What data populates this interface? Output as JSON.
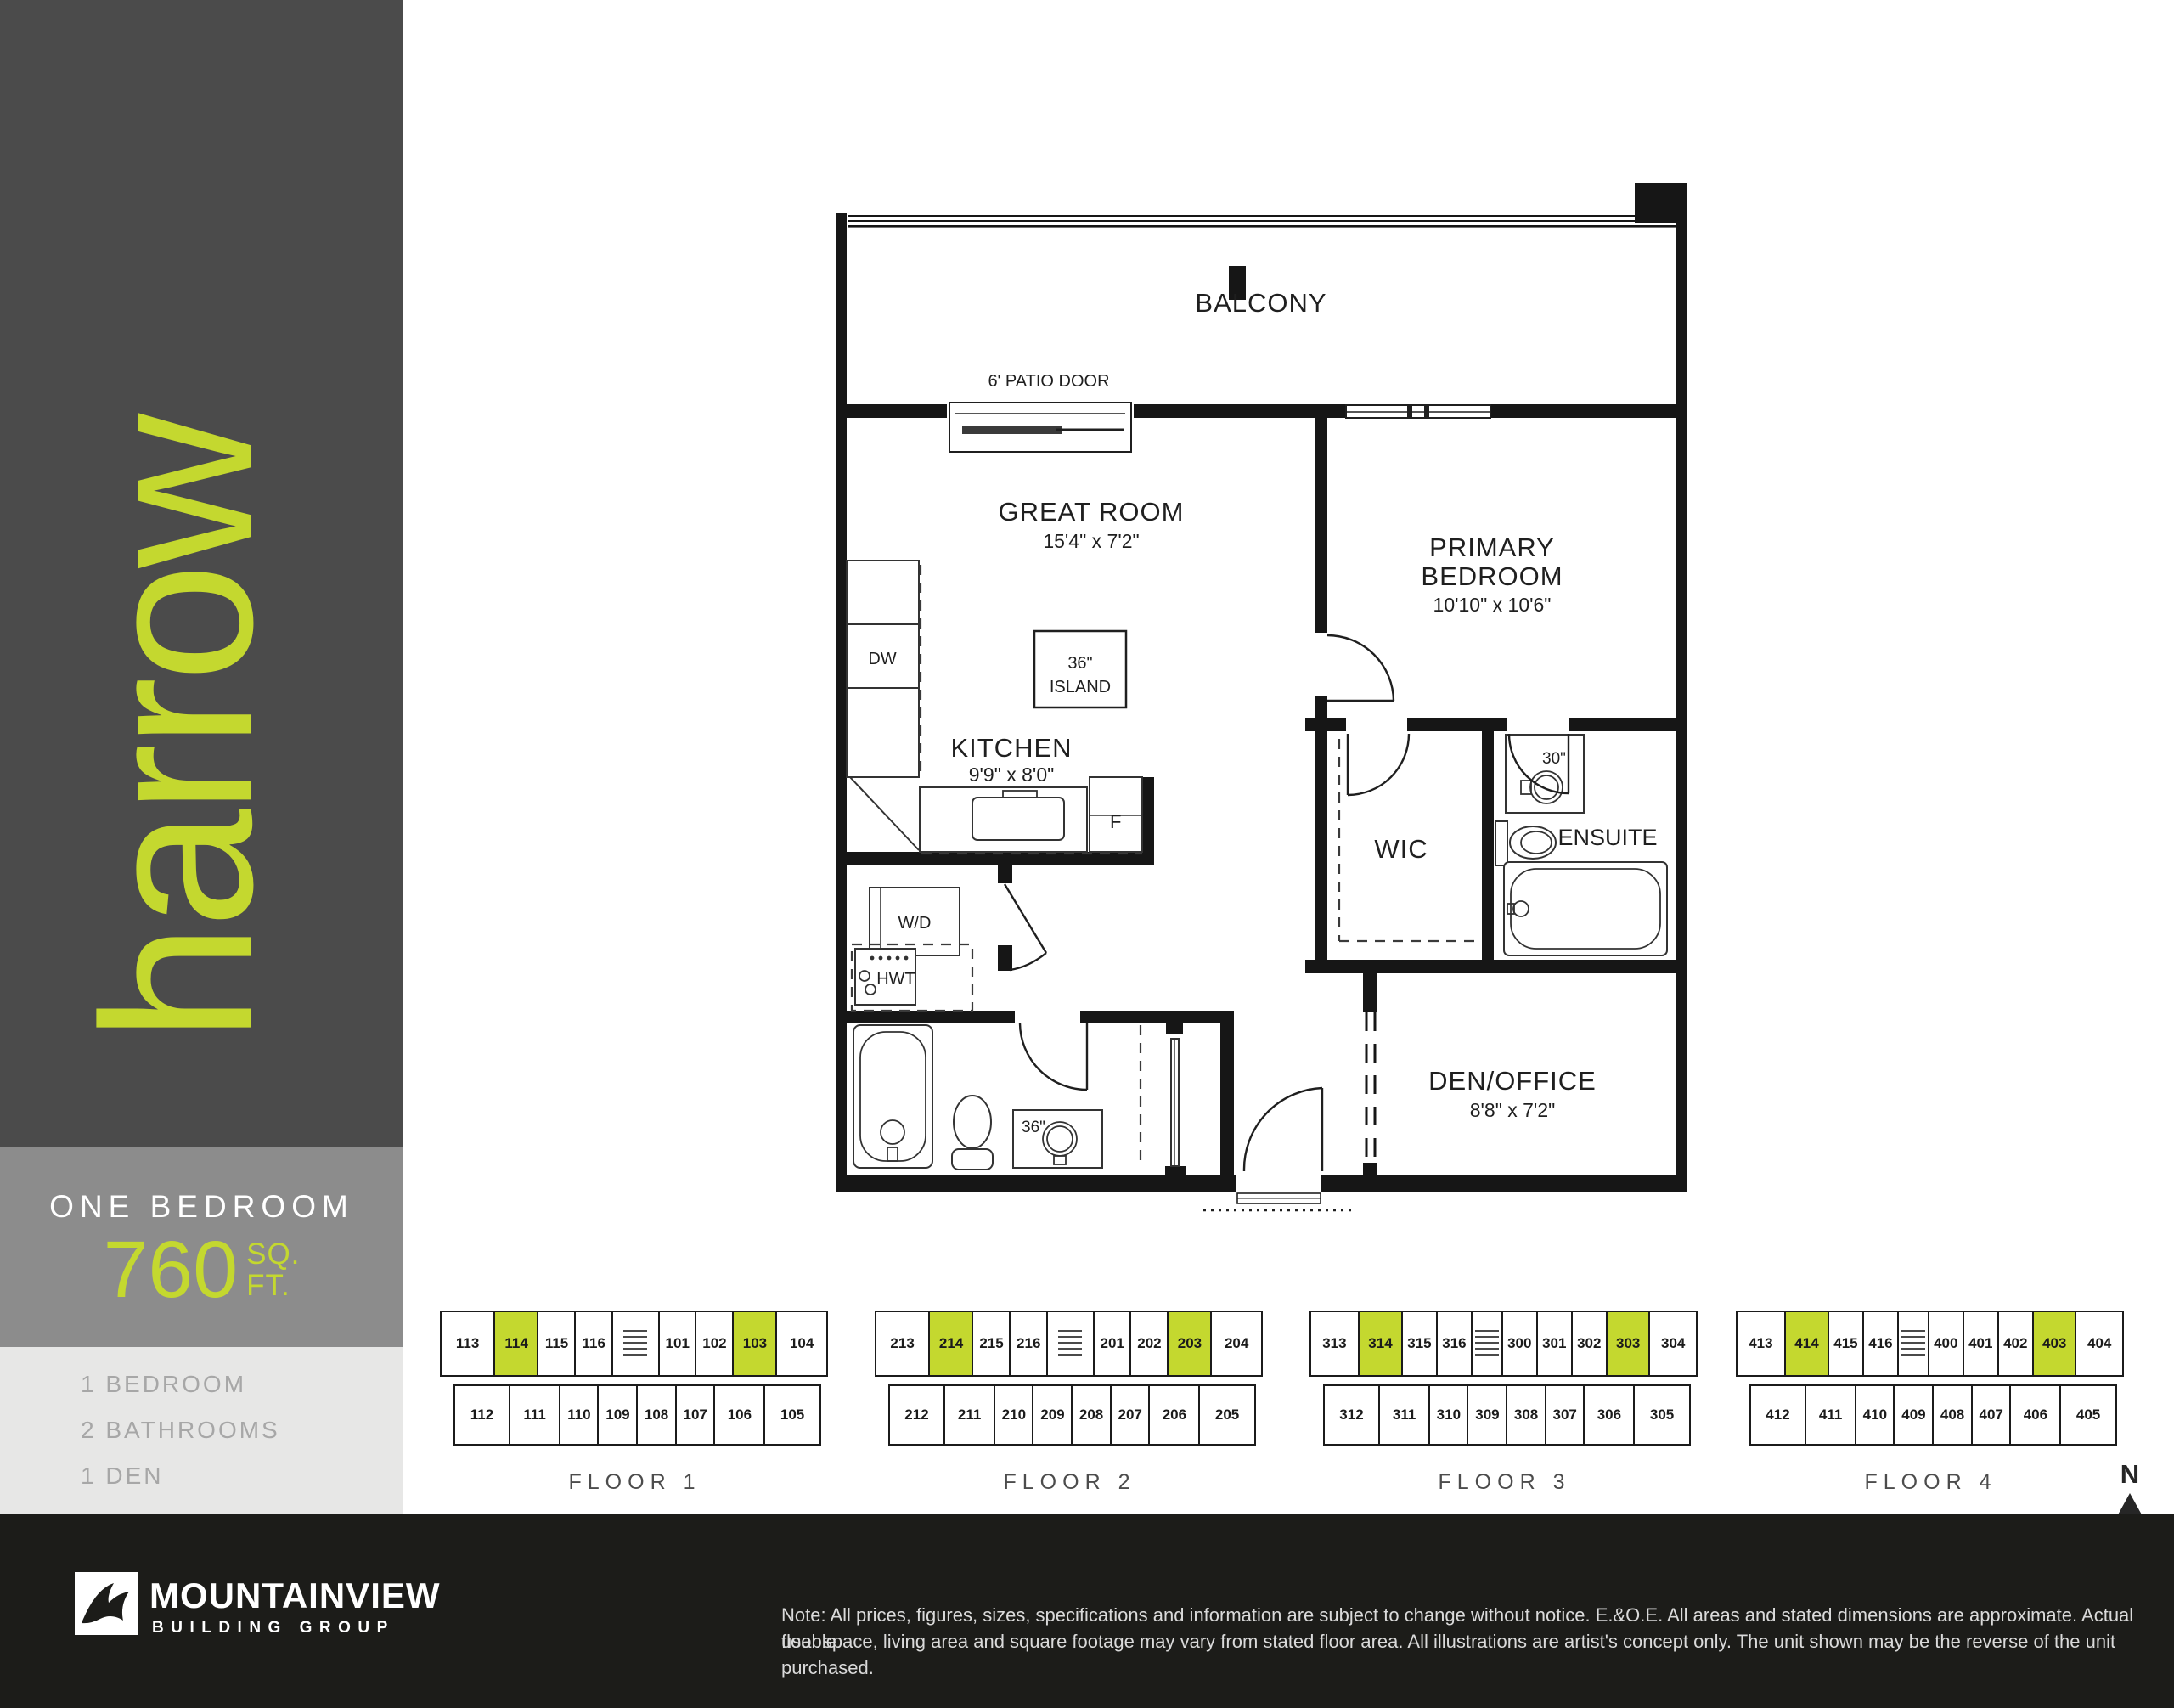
{
  "colors": {
    "brand_lime": "#c4d82f",
    "sidebar_dark": "#4b4b4b",
    "band_gray": "#8c8c8c",
    "band_light": "#e7e7e6",
    "footer_black": "#1c1c19"
  },
  "sidebar": {
    "brand": "harrow",
    "unit_type": "ONE BEDROOM",
    "area_value": "760",
    "area_unit_top": "SQ.",
    "area_unit_bottom": "FT.",
    "features": [
      "1 BEDROOM",
      "2 BATHROOMS",
      "1 DEN"
    ]
  },
  "floor_plan": {
    "labels": {
      "balcony": "BALCONY",
      "patio_door": "6' PATIO DOOR",
      "great_room": "GREAT ROOM",
      "great_room_dims": "15'4\" x 7'2\"",
      "primary_line1": "PRIMARY",
      "primary_line2": "BEDROOM",
      "primary_dims": "10'10\" x 10'6\"",
      "kitchen": "KITCHEN",
      "kitchen_dims": "9'9\" x 8'0\"",
      "island_line1": "36\"",
      "island_line2": "ISLAND",
      "dw": "DW",
      "fridge": "F",
      "wd": "W/D",
      "hwt": "HWT",
      "wic": "WIC",
      "ensuite": "ENSUITE",
      "vanity_30": "30\"",
      "vanity_36": "36\"",
      "den": "DEN/OFFICE",
      "den_dims": "8'8\" x 7'2\""
    }
  },
  "floors": [
    {
      "label": "FLOOR 1",
      "top": [
        {
          "n": "113",
          "w": 1.4
        },
        {
          "n": "114",
          "hl": true,
          "w": 1.12
        },
        {
          "n": "115",
          "w": 0.95
        },
        {
          "n": "116",
          "w": 0.95
        },
        {
          "core": true,
          "w": 1.2
        },
        {
          "n": "101",
          "w": 0.95
        },
        {
          "n": "102",
          "w": 0.95
        },
        {
          "n": "103",
          "hl": true,
          "w": 1.12
        },
        {
          "n": "104",
          "w": 1.3
        }
      ],
      "bottom": [
        {
          "n": "112",
          "w": 1.45
        },
        {
          "n": "111",
          "w": 1.3
        },
        {
          "n": "110",
          "w": 1
        },
        {
          "n": "109",
          "w": 1
        },
        {
          "n": "108",
          "w": 1
        },
        {
          "n": "107",
          "w": 1
        },
        {
          "n": "106",
          "w": 1.3
        },
        {
          "n": "105",
          "w": 1.45
        }
      ]
    },
    {
      "label": "FLOOR 2",
      "top": [
        {
          "n": "213",
          "w": 1.4
        },
        {
          "n": "214",
          "hl": true,
          "w": 1.12
        },
        {
          "n": "215",
          "w": 0.95
        },
        {
          "n": "216",
          "w": 0.95
        },
        {
          "core": true,
          "w": 1.2
        },
        {
          "n": "201",
          "w": 0.95
        },
        {
          "n": "202",
          "w": 0.95
        },
        {
          "n": "203",
          "hl": true,
          "w": 1.12
        },
        {
          "n": "204",
          "w": 1.3
        }
      ],
      "bottom": [
        {
          "n": "212",
          "w": 1.45
        },
        {
          "n": "211",
          "w": 1.3
        },
        {
          "n": "210",
          "w": 1
        },
        {
          "n": "209",
          "w": 1
        },
        {
          "n": "208",
          "w": 1
        },
        {
          "n": "207",
          "w": 1
        },
        {
          "n": "206",
          "w": 1.3
        },
        {
          "n": "205",
          "w": 1.45
        }
      ]
    },
    {
      "label": "FLOOR 3",
      "top": [
        {
          "n": "313",
          "w": 1.3
        },
        {
          "n": "314",
          "hl": true,
          "w": 1.15
        },
        {
          "n": "315",
          "w": 0.92
        },
        {
          "n": "316",
          "w": 0.92
        },
        {
          "core": true,
          "w": 0.8
        },
        {
          "n": "300",
          "w": 0.92
        },
        {
          "n": "301",
          "w": 0.92
        },
        {
          "n": "302",
          "w": 0.92
        },
        {
          "n": "303",
          "hl": true,
          "w": 1.15
        },
        {
          "n": "304",
          "w": 1.25
        }
      ],
      "bottom": [
        {
          "n": "312",
          "w": 1.45
        },
        {
          "n": "311",
          "w": 1.3
        },
        {
          "n": "310",
          "w": 1
        },
        {
          "n": "309",
          "w": 1
        },
        {
          "n": "308",
          "w": 1
        },
        {
          "n": "307",
          "w": 1
        },
        {
          "n": "306",
          "w": 1.3
        },
        {
          "n": "305",
          "w": 1.45
        }
      ]
    },
    {
      "label": "FLOOR 4",
      "top": [
        {
          "n": "413",
          "w": 1.3
        },
        {
          "n": "414",
          "hl": true,
          "w": 1.15
        },
        {
          "n": "415",
          "w": 0.92
        },
        {
          "n": "416",
          "w": 0.92
        },
        {
          "core": true,
          "w": 0.8
        },
        {
          "n": "400",
          "w": 0.92
        },
        {
          "n": "401",
          "w": 0.92
        },
        {
          "n": "402",
          "w": 0.92
        },
        {
          "n": "403",
          "hl": true,
          "w": 1.15
        },
        {
          "n": "404",
          "w": 1.25
        }
      ],
      "bottom": [
        {
          "n": "412",
          "w": 1.45
        },
        {
          "n": "411",
          "w": 1.3
        },
        {
          "n": "410",
          "w": 1
        },
        {
          "n": "409",
          "w": 1
        },
        {
          "n": "408",
          "w": 1
        },
        {
          "n": "407",
          "w": 1
        },
        {
          "n": "406",
          "w": 1.3
        },
        {
          "n": "405",
          "w": 1.45
        }
      ]
    }
  ],
  "compass": {
    "n": "N"
  },
  "footer": {
    "brand_line1": "MOUNTAINVIEW",
    "brand_line2": "BUILDING GROUP",
    "disclaimer_line1": "Note: All prices, figures, sizes, specifications and information are subject to change without notice. E.&O.E. All areas and stated dimensions are approximate. Actual usable",
    "disclaimer_line2": "floor space, living area and square footage may vary from stated floor area. All illustrations are artist's concept only. The unit shown may be the reverse of the unit purchased."
  }
}
